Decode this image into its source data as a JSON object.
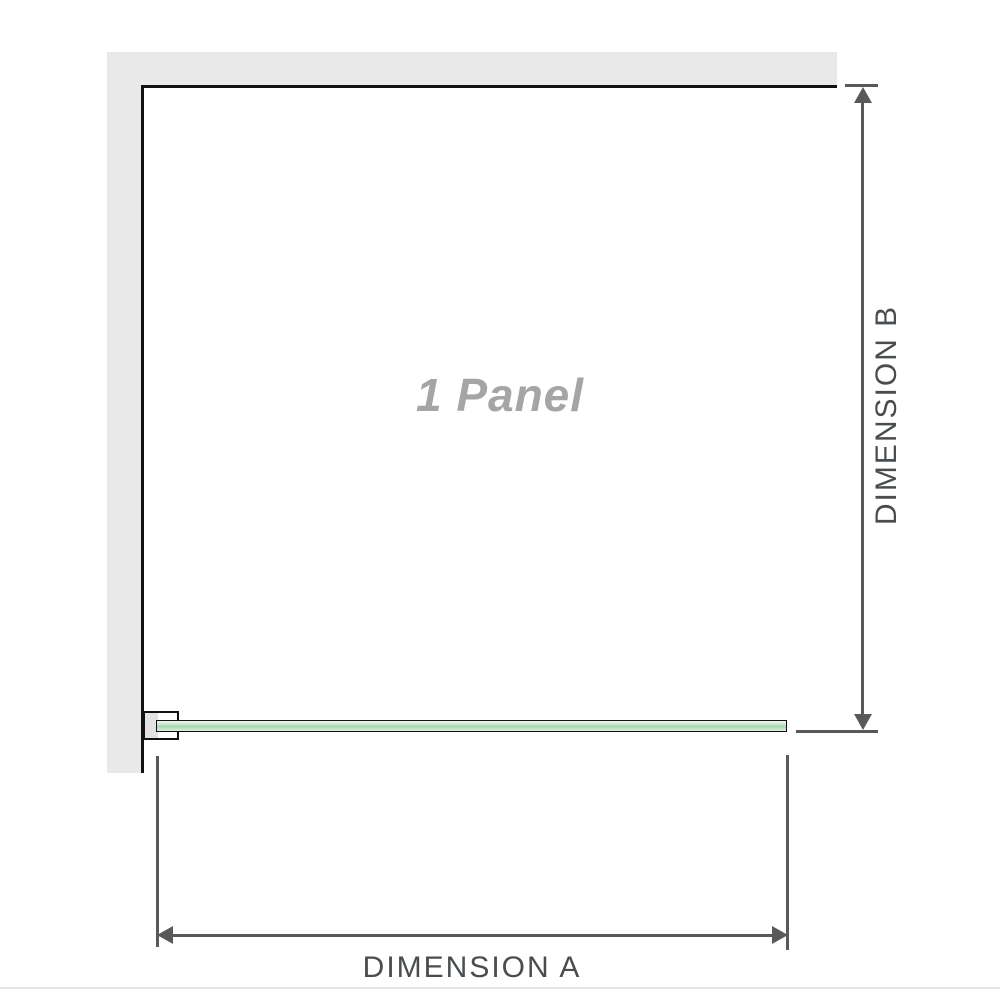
{
  "diagram": {
    "panel_label": "1 Panel",
    "dimension_a": {
      "label": "DIMENSION A"
    },
    "dimension_b": {
      "label": "DIMENSION B"
    },
    "colors": {
      "bg": "#ffffff",
      "wall": "#e9e9e9",
      "outline": "#111111",
      "glass": "#a6d7b2",
      "dimline": "#58595b",
      "labeltext": "#4a4d4f",
      "paneltext": "#a5a5a5",
      "divider": "#e7e4df"
    }
  }
}
